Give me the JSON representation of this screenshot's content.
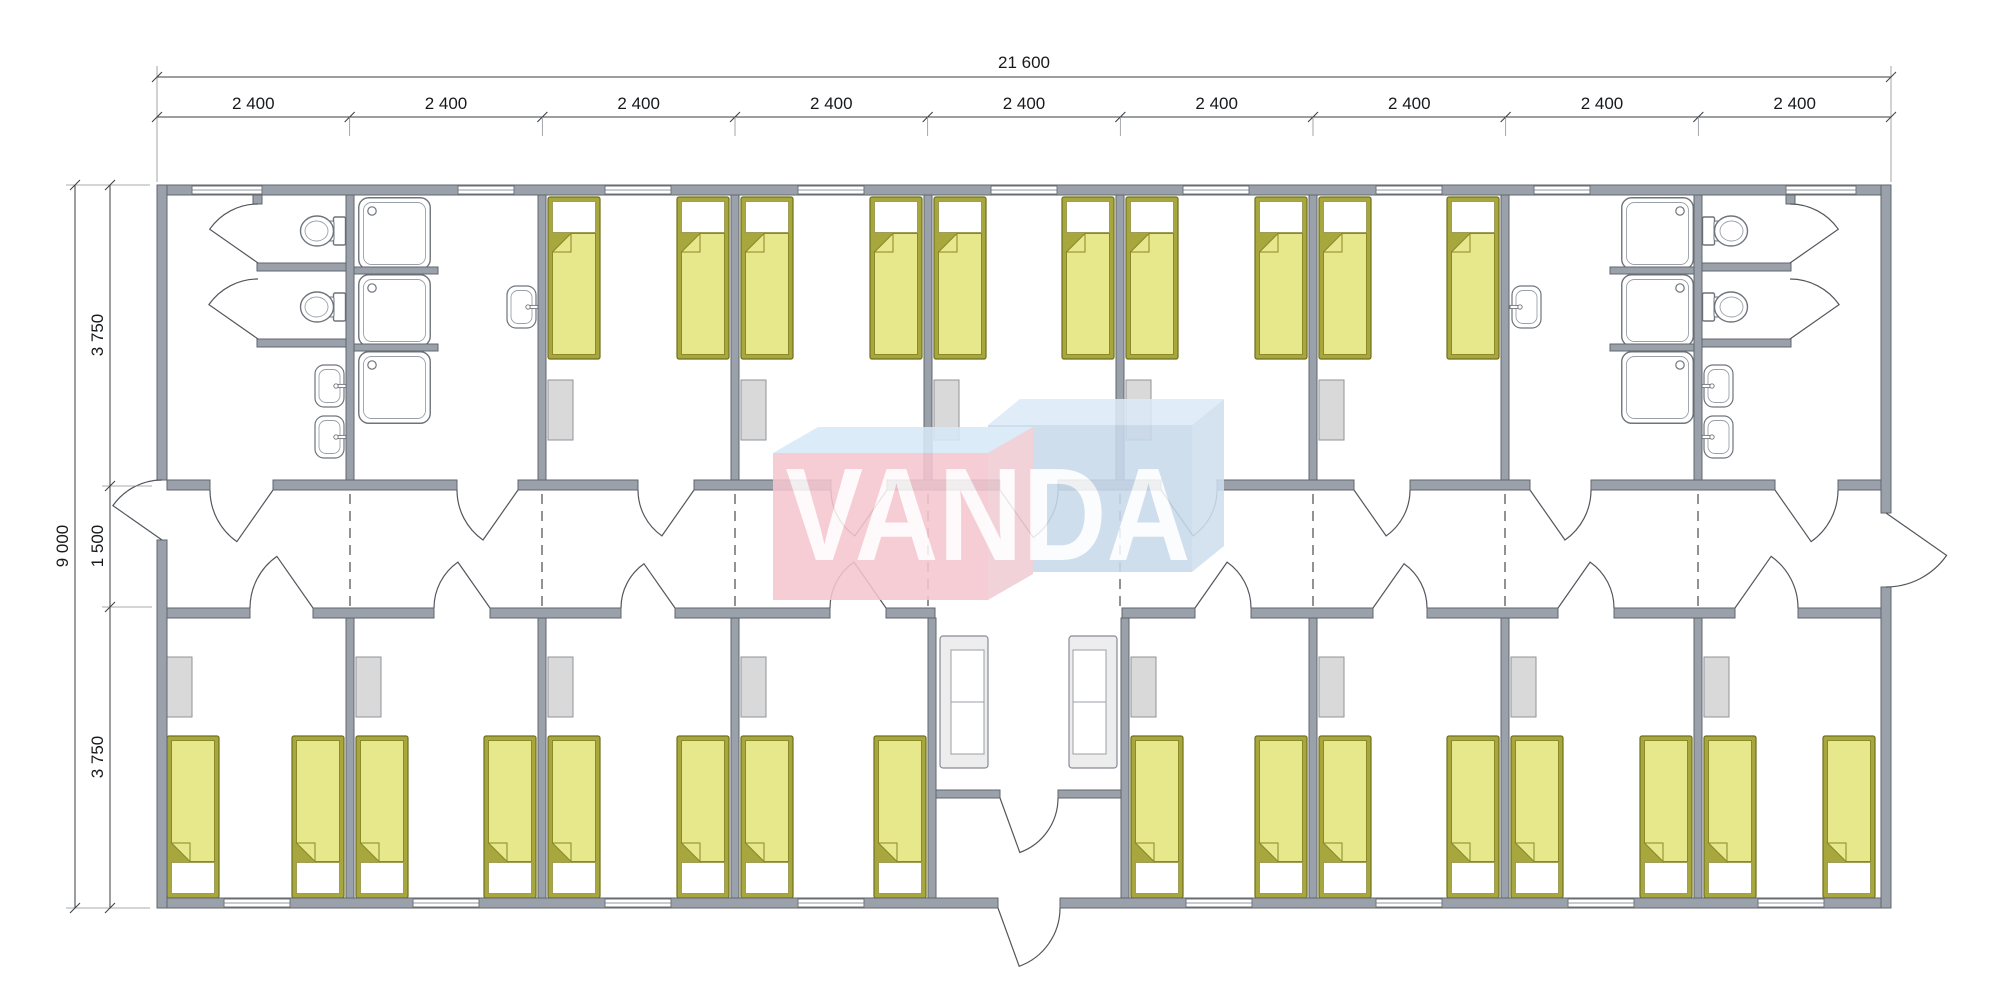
{
  "watermark": {
    "text": "VANDA"
  },
  "dimensions": {
    "total_width_label": "21 600",
    "module_width_label": "2 400",
    "module_count": 9,
    "total_height_label": "9 000",
    "upper_rooms_depth_label": "3 750",
    "corridor_width_label": "1 500",
    "lower_rooms_depth_label": "3 750"
  },
  "colors": {
    "wall": "#9ba1ab",
    "wall_stroke": "#62666d",
    "bed_frame": "#a7a73d",
    "bed_frame_stroke": "#6f6f1d",
    "bed_blanket": "#e7e78c",
    "bed_blanket_stroke": "#8a8a28",
    "wardrobe": "#d9d9d9",
    "fixture_stroke": "#6f747c",
    "logo_pink": "#f5c6cf",
    "logo_pink_side": "#f0ccd4",
    "logo_blue_front": "#c9daeb",
    "logo_blue_top": "#dceaf6",
    "logo_blue_top2": "#d7e9f7",
    "logo_blue_side": "#cfdff0",
    "logo_text": "#ffffff"
  },
  "plan": {
    "building": {
      "x": 157,
      "y": 185,
      "w": 1734,
      "h": 723
    },
    "walls": [
      [
        157,
        185,
        1734,
        10
      ],
      [
        157,
        898,
        841,
        10
      ],
      [
        1060,
        898,
        831,
        10
      ],
      [
        157,
        185,
        10,
        295
      ],
      [
        157,
        540,
        10,
        368
      ],
      [
        1881,
        185,
        10,
        328
      ],
      [
        1881,
        587,
        10,
        321
      ],
      [
        167,
        480,
        43,
        10
      ],
      [
        273,
        480,
        184,
        10
      ],
      [
        518,
        480,
        120,
        10
      ],
      [
        694,
        480,
        137,
        10
      ],
      [
        887,
        480,
        113,
        10
      ],
      [
        1058,
        480,
        103,
        10
      ],
      [
        1217,
        480,
        137,
        10
      ],
      [
        1410,
        480,
        120,
        10
      ],
      [
        1591,
        480,
        184,
        10
      ],
      [
        1838,
        480,
        43,
        10
      ],
      [
        167,
        608,
        83,
        10
      ],
      [
        313,
        608,
        121,
        10
      ],
      [
        490,
        608,
        131,
        10
      ],
      [
        675,
        608,
        155,
        10
      ],
      [
        886,
        608,
        49,
        10
      ],
      [
        1122,
        608,
        73,
        10
      ],
      [
        1251,
        608,
        122,
        10
      ],
      [
        1427,
        608,
        131,
        10
      ],
      [
        1614,
        608,
        121,
        10
      ],
      [
        1798,
        608,
        83,
        10
      ],
      [
        346,
        195,
        8,
        285
      ],
      [
        538,
        195,
        8,
        285
      ],
      [
        731,
        195,
        8,
        285
      ],
      [
        924,
        195,
        8,
        285
      ],
      [
        1116,
        195,
        8,
        285
      ],
      [
        1309,
        195,
        8,
        285
      ],
      [
        1501,
        195,
        8,
        285
      ],
      [
        1694,
        195,
        8,
        285
      ],
      [
        346,
        618,
        8,
        280
      ],
      [
        538,
        618,
        8,
        280
      ],
      [
        731,
        618,
        8,
        280
      ],
      [
        1309,
        618,
        8,
        280
      ],
      [
        1501,
        618,
        8,
        280
      ],
      [
        1694,
        618,
        8,
        280
      ],
      [
        928,
        618,
        8,
        280
      ],
      [
        1121,
        618,
        8,
        280
      ],
      [
        936,
        790,
        64,
        8
      ],
      [
        1058,
        790,
        63,
        8
      ],
      [
        257,
        263,
        89,
        8
      ],
      [
        257,
        339,
        89,
        8
      ],
      [
        1702,
        263,
        89,
        8
      ],
      [
        1702,
        339,
        89,
        8
      ],
      [
        253,
        195,
        9,
        9
      ],
      [
        1786,
        195,
        9,
        9
      ],
      [
        354,
        267,
        84,
        7
      ],
      [
        354,
        344,
        84,
        7
      ],
      [
        1610,
        267,
        84,
        7
      ],
      [
        1610,
        344,
        84,
        7
      ]
    ],
    "windows_top": [
      [
        192,
        70
      ],
      [
        458,
        56
      ],
      [
        605,
        66
      ],
      [
        798,
        66
      ],
      [
        991,
        66
      ],
      [
        1183,
        66
      ],
      [
        1376,
        66
      ],
      [
        1534,
        56
      ],
      [
        1786,
        70
      ]
    ],
    "windows_bottom": [
      [
        224,
        66
      ],
      [
        413,
        66
      ],
      [
        605,
        66
      ],
      [
        798,
        66
      ],
      [
        1186,
        66
      ],
      [
        1376,
        66
      ],
      [
        1568,
        66
      ],
      [
        1758,
        66
      ]
    ],
    "module_joint_dashes": [
      350,
      542,
      735,
      928,
      1120,
      1313,
      1505,
      1698
    ],
    "beds_top": [
      548,
      677,
      741,
      870,
      934,
      1062,
      1126,
      1255,
      1319,
      1447
    ],
    "beds_bottom": [
      167,
      292,
      356,
      484,
      548,
      677,
      741,
      874,
      1131,
      1255,
      1319,
      1447,
      1511,
      1640,
      1704,
      1823
    ],
    "wardrobes_top": [
      548,
      741,
      934,
      1126,
      1319
    ],
    "wardrobes_bottom": [
      167,
      356,
      548,
      741,
      1131,
      1319,
      1511,
      1704
    ],
    "showers": [
      {
        "x": 358,
        "y": 197,
        "m": 1
      },
      {
        "x": 358,
        "y": 274,
        "m": 1
      },
      {
        "x": 358,
        "y": 351,
        "m": 1
      },
      {
        "x": 1621,
        "y": 197,
        "m": -1
      },
      {
        "x": 1621,
        "y": 274,
        "m": -1
      },
      {
        "x": 1621,
        "y": 351,
        "m": -1
      }
    ],
    "toilets": [
      {
        "x": 346,
        "y": 231,
        "m": 1
      },
      {
        "x": 346,
        "y": 307,
        "m": 1
      },
      {
        "x": 1702,
        "y": 231,
        "m": -1
      },
      {
        "x": 1702,
        "y": 307,
        "m": -1
      }
    ],
    "sinks": [
      {
        "x": 346,
        "y": 386,
        "m": 1
      },
      {
        "x": 346,
        "y": 437,
        "m": 1
      },
      {
        "x": 538,
        "y": 307,
        "m": 1
      },
      {
        "x": 1702,
        "y": 386,
        "m": -1
      },
      {
        "x": 1702,
        "y": 437,
        "m": -1
      },
      {
        "x": 1510,
        "y": 307,
        "m": -1
      }
    ],
    "sofas": [
      {
        "x": 940,
        "y": 636,
        "m": 1
      },
      {
        "x": 1069,
        "y": 636,
        "m": -1
      }
    ],
    "doors": [
      {
        "h": [
          273,
          490
        ],
        "j": [
          210,
          490
        ],
        "a": -55
      },
      {
        "h": [
          518,
          490
        ],
        "j": [
          457,
          490
        ],
        "a": -55
      },
      {
        "h": [
          694,
          490
        ],
        "j": [
          638,
          490
        ],
        "a": -55
      },
      {
        "h": [
          887,
          490
        ],
        "j": [
          831,
          490
        ],
        "a": -55
      },
      {
        "h": [
          1000,
          490
        ],
        "j": [
          1058,
          490
        ],
        "a": 55
      },
      {
        "h": [
          1161,
          490
        ],
        "j": [
          1217,
          490
        ],
        "a": 55
      },
      {
        "h": [
          1354,
          490
        ],
        "j": [
          1410,
          490
        ],
        "a": 55
      },
      {
        "h": [
          1530,
          490
        ],
        "j": [
          1591,
          490
        ],
        "a": 55
      },
      {
        "h": [
          1775,
          490
        ],
        "j": [
          1838,
          490
        ],
        "a": 55
      },
      {
        "h": [
          313,
          608
        ],
        "j": [
          250,
          608
        ],
        "a": 55
      },
      {
        "h": [
          490,
          608
        ],
        "j": [
          434,
          608
        ],
        "a": 55
      },
      {
        "h": [
          675,
          608
        ],
        "j": [
          621,
          608
        ],
        "a": 55
      },
      {
        "h": [
          886,
          608
        ],
        "j": [
          830,
          608
        ],
        "a": 55
      },
      {
        "h": [
          1195,
          608
        ],
        "j": [
          1251,
          608
        ],
        "a": -55
      },
      {
        "h": [
          1373,
          608
        ],
        "j": [
          1427,
          608
        ],
        "a": -55
      },
      {
        "h": [
          1558,
          608
        ],
        "j": [
          1614,
          608
        ],
        "a": -55
      },
      {
        "h": [
          1735,
          608
        ],
        "j": [
          1798,
          608
        ],
        "a": -55
      },
      {
        "h": [
          162,
          540
        ],
        "j": [
          162,
          480
        ],
        "a": -55
      },
      {
        "h": [
          1886,
          513
        ],
        "j": [
          1886,
          587
        ],
        "a": -55
      },
      {
        "h": [
          258,
          263
        ],
        "j": [
          258,
          204
        ],
        "a": -55
      },
      {
        "h": [
          258,
          339
        ],
        "j": [
          258,
          279
        ],
        "a": -55
      },
      {
        "h": [
          1790,
          263
        ],
        "j": [
          1790,
          204
        ],
        "a": 55
      },
      {
        "h": [
          1790,
          339
        ],
        "j": [
          1790,
          279
        ],
        "a": 55
      },
      {
        "h": [
          1000,
          798
        ],
        "j": [
          1058,
          798
        ],
        "a": 70
      },
      {
        "h": [
          998,
          908
        ],
        "j": [
          1060,
          908
        ],
        "a": 70
      }
    ],
    "dim_lines": [
      [
        157,
        77,
        1891,
        77
      ],
      [
        157,
        117,
        1891,
        117
      ],
      [
        75,
        185,
        75,
        908
      ],
      [
        110,
        185,
        110,
        908
      ]
    ],
    "ext_lines": [
      [
        157,
        66,
        157,
        182
      ],
      [
        1891,
        66,
        1891,
        182
      ],
      [
        66,
        185,
        150,
        185
      ],
      [
        66,
        908,
        150,
        908
      ],
      [
        102,
        486,
        152,
        486
      ],
      [
        102,
        607,
        152,
        607
      ]
    ],
    "dim_ticks": [
      [
        157,
        77
      ],
      [
        1891,
        77
      ],
      [
        75,
        185
      ],
      [
        75,
        908
      ],
      [
        110,
        185
      ],
      [
        110,
        486
      ],
      [
        110,
        607
      ],
      [
        110,
        908
      ]
    ]
  }
}
